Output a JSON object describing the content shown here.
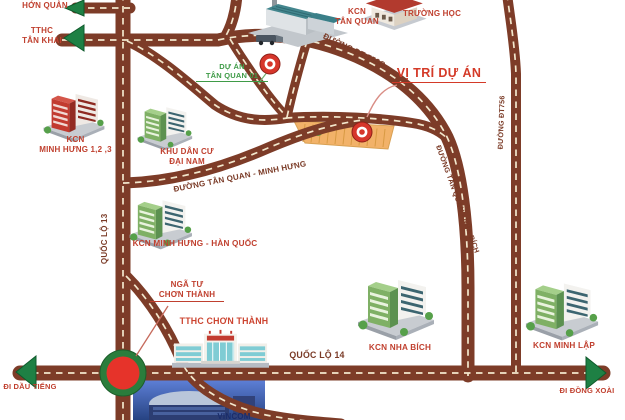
{
  "title": "Sơ đồ vị trí dự án",
  "labels": {
    "hon_quan": {
      "l1": "TTHC",
      "l2": "HỚN QUẢN"
    },
    "tan_khai": {
      "l1": "TTHC",
      "l2": "TÂN KHAI"
    },
    "kcn_tan_quan": {
      "l1": "KCN",
      "l2": "TÂN QUAN"
    },
    "truong_hoc": {
      "text": "TRƯỜNG HỌC"
    },
    "du_an": {
      "l1": "DỰ ÁN",
      "l2": "TÂN QUAN 01"
    },
    "vi_tri_du_an": {
      "text": "VỊ TRÍ DỰ ÁN"
    },
    "kcn_minh_hung_123": {
      "l1": "KCN",
      "l2": "MINH HƯNG 1,2 ,3"
    },
    "khu_dan_cu": {
      "l1": "KHU DÂN CƯ",
      "l2": "ĐẠI NAM"
    },
    "duong_tan_quan_minh_hung": {
      "text": "ĐƯỜNG TÂN QUAN - MINH HƯNG"
    },
    "kcn_minh_hung_han_quoc": {
      "text": "KCN MINH HƯNG - HÀN QUỐC"
    },
    "quoc_lo_13": {
      "text": "QUỐC LỘ 13"
    },
    "nga_tu": {
      "l1": "NGÃ TƯ",
      "l2": "CHƠN THÀNH"
    },
    "tthc_chon_thanh": {
      "text": "TTHC CHƠN THÀNH"
    },
    "quoc_lo_14": {
      "text": "QUỐC LỘ 14"
    },
    "kcn_nha_bich": {
      "text": "KCN NHA BÍCH"
    },
    "kcn_minh_lap": {
      "text": "KCN MINH LẬP"
    },
    "di_dau_tieng": {
      "text": "ĐI DẦU TIẾNG"
    },
    "di_dong_xoai": {
      "text": "ĐI ĐỒNG XOÀI"
    },
    "duong_dt_756c": {
      "text": "ĐƯỜNG ĐT 756C"
    },
    "duong_tan_quan_nha_bich": {
      "text": "ĐƯỜNG TÂN QUAN - NHA BÍCH"
    },
    "duong_dt756": {
      "text": "ĐƯỜNG ĐT756"
    },
    "vincom": {
      "text": "VINCOM"
    }
  },
  "colors": {
    "road": "#7d3c28",
    "dash": "#f2e7cc",
    "label_red": "#c0402f",
    "label_green": "#3f9b47",
    "label_brown": "#7a3a26",
    "label_orange": "#cc4430",
    "vi_tri_red": "#d43a28",
    "arrow_green": "#1e8044",
    "marker_red": "#d6362b",
    "roundabout_ring": "#2a7d3c",
    "roundabout_fill": "#e6332a",
    "strip": "#f2b269"
  }
}
